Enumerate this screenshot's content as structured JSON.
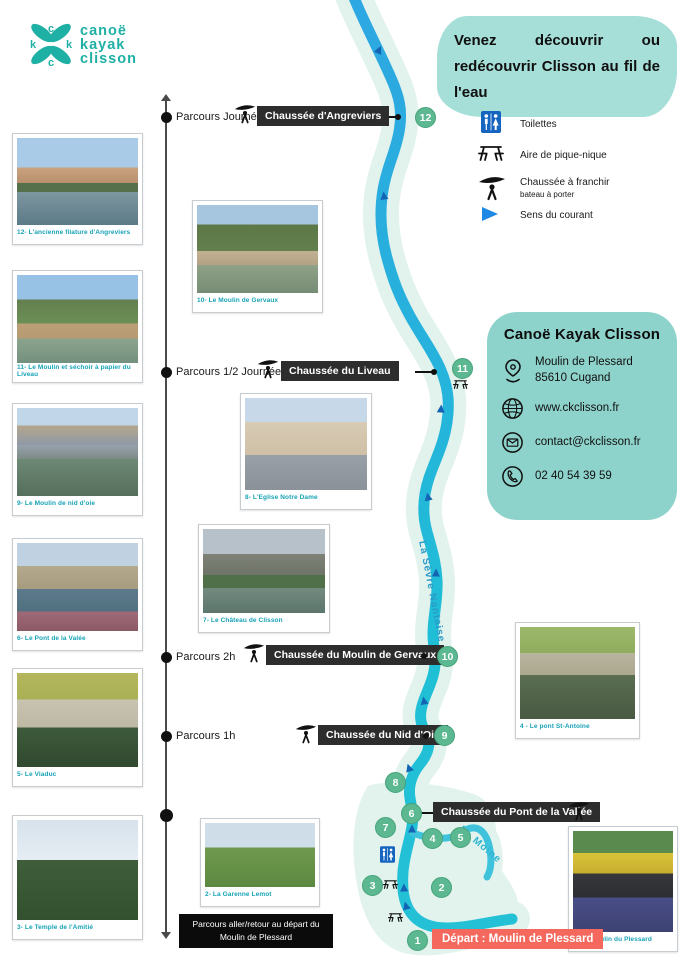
{
  "logo": {
    "line1": "canoë",
    "line2": "kayak",
    "line3": "clisson"
  },
  "headline": "Venez découvrir ou redécouvrir Clisson au fil de l'eau",
  "legend": {
    "toilets": "Toilettes",
    "picnic": "Aire de pique-nique",
    "chaussee": "Chaussée à franchir",
    "chaussee_sub": "bateau à porter",
    "current": "Sens du courant"
  },
  "contact": {
    "title": "Canoë Kayak Clisson",
    "address1": "Moulin de Plessard",
    "address2": "85610 Cugand",
    "website": "www.ckclisson.fr",
    "email": "contact@ckclisson.fr",
    "phone": "02 40 54 39 59"
  },
  "timeline": {
    "labels": [
      "Parcours Journée",
      "Parcours 1/2 Journée",
      "Parcours 2h",
      "Parcours 1h"
    ],
    "return_note": "Parcours aller/retour au départ du Moulin de Plessard"
  },
  "chaussees": [
    "Chaussée d'Angreviers",
    "Chaussée du Liveau",
    "Chaussée du Moulin de Gervaux",
    "Chaussée du Nid d'Oie",
    "Chaussée du Pont de la Vallée"
  ],
  "depart": "Départ : Moulin de Plessard",
  "rivers": {
    "main": "La Sèvre Nantaise",
    "tributary": "La Moine"
  },
  "points": [
    "1",
    "2",
    "3",
    "4",
    "5",
    "6",
    "7",
    "8",
    "9",
    "10",
    "11",
    "12"
  ],
  "photos": [
    {
      "caption": "12- L'ancienne filature d'Angreviers"
    },
    {
      "caption": "11- Le Moulin et séchoir à papier du Liveau"
    },
    {
      "caption": "10- Le Moulin de Gervaux"
    },
    {
      "caption": "9- Le Moulin de nid d'oie"
    },
    {
      "caption": "8- L'Eglise Notre Dame"
    },
    {
      "caption": "7- Le Château de Clisson"
    },
    {
      "caption": "6- Le Pont de la Valée"
    },
    {
      "caption": "5- Le Viaduc"
    },
    {
      "caption": "4 - Le pont St-Antoine"
    },
    {
      "caption": "3- Le Temple de l'Amitié"
    },
    {
      "caption": "2- La Garenne Lemot"
    },
    {
      "caption": "1- Le Moulin du Plessard"
    }
  ],
  "colors": {
    "brand_teal": "#1fb0a5",
    "blob_teal": "#a6ded8",
    "card_teal": "#8ed3cb",
    "river_blue_top": "#2ea7e2",
    "river_teal_bottom": "#24c1d6",
    "river_halo": "#e1f3ec",
    "point_green": "#5cb890",
    "label_dark": "#2d2d2d",
    "depart_red": "#f4685d",
    "caption_teal": "#17a2b5",
    "toilet_blue": "#1565c0",
    "arrow_blue": "#1e88e5"
  }
}
